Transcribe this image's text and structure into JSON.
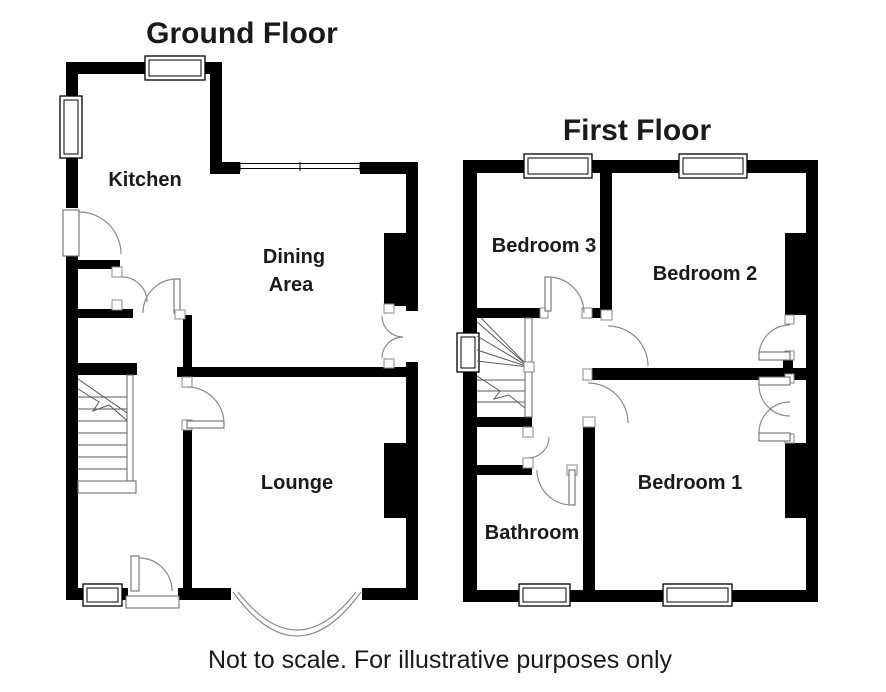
{
  "ground_floor": {
    "title": "Ground Floor",
    "rooms": {
      "kitchen": "Kitchen",
      "dining_line1": "Dining",
      "dining_line2": "Area",
      "lounge": "Lounge"
    }
  },
  "first_floor": {
    "title": "First Floor",
    "rooms": {
      "bedroom3": "Bedroom 3",
      "bedroom2": "Bedroom 2",
      "bedroom1": "Bedroom 1",
      "bathroom": "Bathroom"
    }
  },
  "footer": {
    "disclaimer": "Not to scale. For illustrative purposes only"
  },
  "colors": {
    "wall": "#000000",
    "background": "#ffffff",
    "thin_line": "#8a8a8a"
  }
}
